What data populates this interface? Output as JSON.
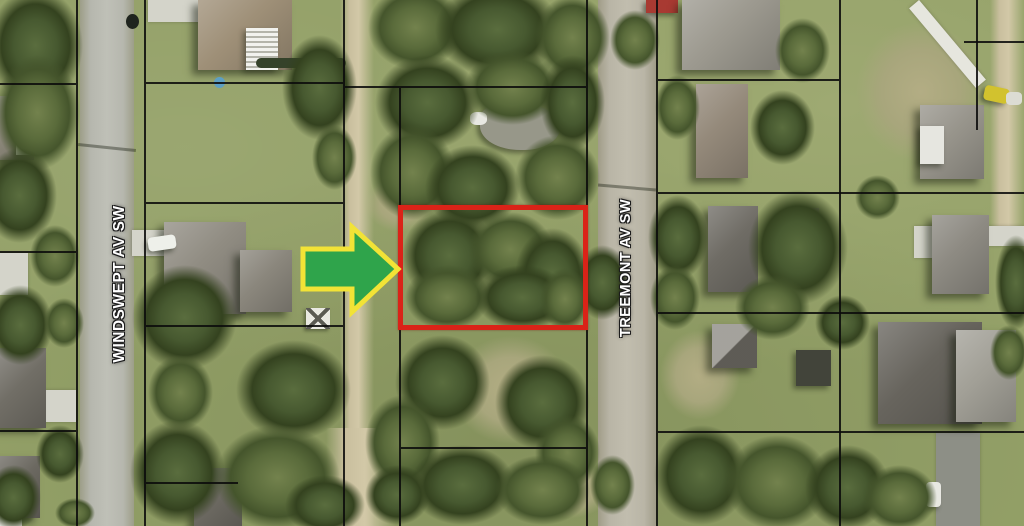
{
  "map": {
    "description": "Aerial parcel map with highlighted vacant lot",
    "street_labels": [
      {
        "name": "WINDSWEPT AV SW"
      },
      {
        "name": "TREEMONT AV SW"
      }
    ],
    "highlight_box": {
      "shape": "rectangle"
    },
    "arrow": {
      "direction": "right"
    },
    "colors": {
      "grass": "#93a067",
      "tree-dark": "#46592f",
      "road": "#b6b7ae",
      "dirt": "#c9bf9e",
      "line": "#0b0b0b",
      "label": "#ffffff",
      "highlight": "#da2318",
      "arrow-fill": "#2fa44b",
      "arrow-outline": "#f2e336"
    }
  }
}
